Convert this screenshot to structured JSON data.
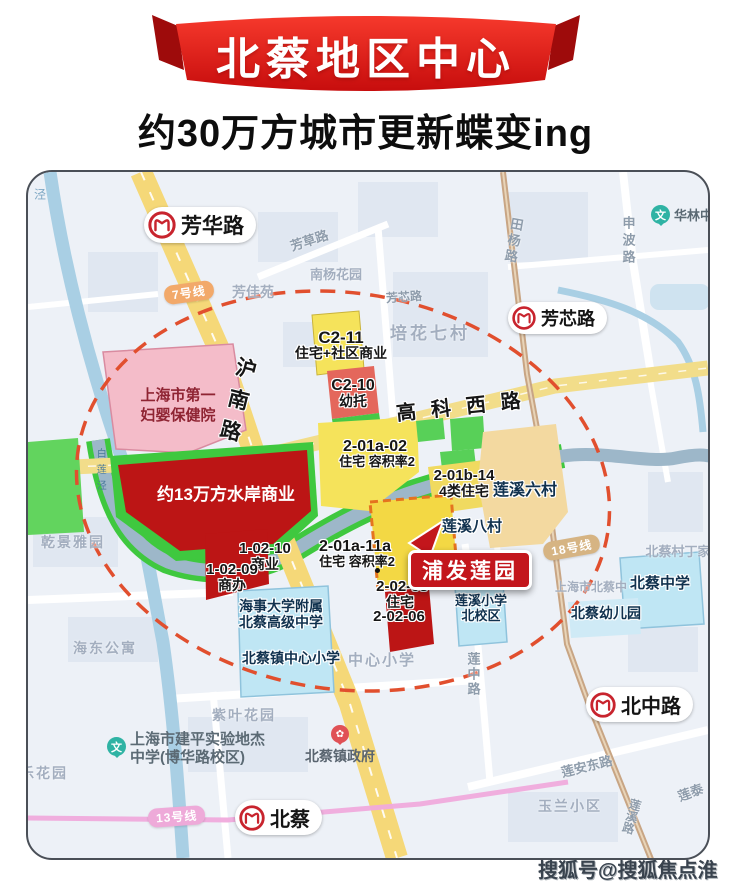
{
  "banner": {
    "title": "北蔡地区中心",
    "subtitle": "约30万方城市更新蝶变ing"
  },
  "watermark": "搜狐号@搜狐焦点淮南站",
  "highlight": {
    "badge": "浦发莲园"
  },
  "stations": {
    "fanghua": "芳华路",
    "fangxin": "芳芯路",
    "beicai": "北蔡",
    "beizhonglu": "北中路"
  },
  "metro_lines": {
    "line7": "7号线",
    "line13": "13号线",
    "line18": "18号线"
  },
  "roads": {
    "hunan": "沪南路",
    "gaokexi": "高科西路",
    "fangcao": "芳草路",
    "shenbo": "申波路",
    "tianyang": "田杨路",
    "lianzhong": "莲中路",
    "lianandong": "莲安东路",
    "fangxin_road": "芳芯路",
    "lianxi_road": "莲溪路",
    "liantai": "莲泰",
    "jing": "泾",
    "bailianjing": "白莲泾"
  },
  "parcels": {
    "c211": {
      "code": "C2-11",
      "use": "住宅+社区商业"
    },
    "c210": {
      "code": "C2-10",
      "use": "幼托"
    },
    "p201a02": {
      "code": "2-01a-02",
      "use": "住宅 容积率2"
    },
    "p201a11a": {
      "code": "2-01a-11a",
      "use": "住宅 容积率2"
    },
    "p201b14": {
      "code": "2-01b-14",
      "use": "4类住宅"
    },
    "p10210": {
      "code": "1-02-10",
      "use": "商业"
    },
    "p10209": {
      "code": "1-02-09",
      "use": "商办"
    },
    "p20203": {
      "code": "2-02-03",
      "use": "住宅"
    },
    "p20206": {
      "code": "2-02-06"
    },
    "waterfront": {
      "label": "约13万方水岸商业"
    }
  },
  "places": {
    "hospital_l1": "上海市第一",
    "hospital_l2": "妇婴保健院",
    "nanyang": "南杨花园",
    "fangjia": "芳佳苑",
    "peihua": "培花七村",
    "hualin": "华林中",
    "lianxi6": "莲溪六村",
    "lianxi8": "莲溪八村",
    "beicaicun": "北蔡村丁家",
    "qianjing": "乾景雅园",
    "haidong": "海东公寓",
    "ziye": "紫叶花园",
    "yulan": "玉兰小区",
    "lehuayuan": "乐花园",
    "zhongxin_gray": "中心小学",
    "beicai_zhong_gray": "上海市北蔡中",
    "beicai_middle": "北蔡中学",
    "beicai_kindergarten": "北蔡幼儿园",
    "beicai_gov": "北蔡镇政府",
    "beicai_center_primary": "北蔡镇中心小学",
    "haishi_l1": "海事大学附属",
    "haishi_l2": "北蔡高级中学",
    "lianxi_primary_l1": "莲溪小学",
    "lianxi_primary_l2": "北校区",
    "jianping_l1": "上海市建平实验地杰",
    "jianping_l2": "中学(博华路校区)"
  },
  "icons": {
    "education_glyph": "文",
    "gov_glyph": "✿"
  },
  "colors": {
    "banner_red": "#e02318",
    "parcel_yellow": "#f5e35b",
    "parcel_red": "#bc1515",
    "school_blue": "#bfe6f4",
    "green": "#3fc83f",
    "circle_dash": "#e14f2e",
    "metro_red": "#c8242e"
  }
}
